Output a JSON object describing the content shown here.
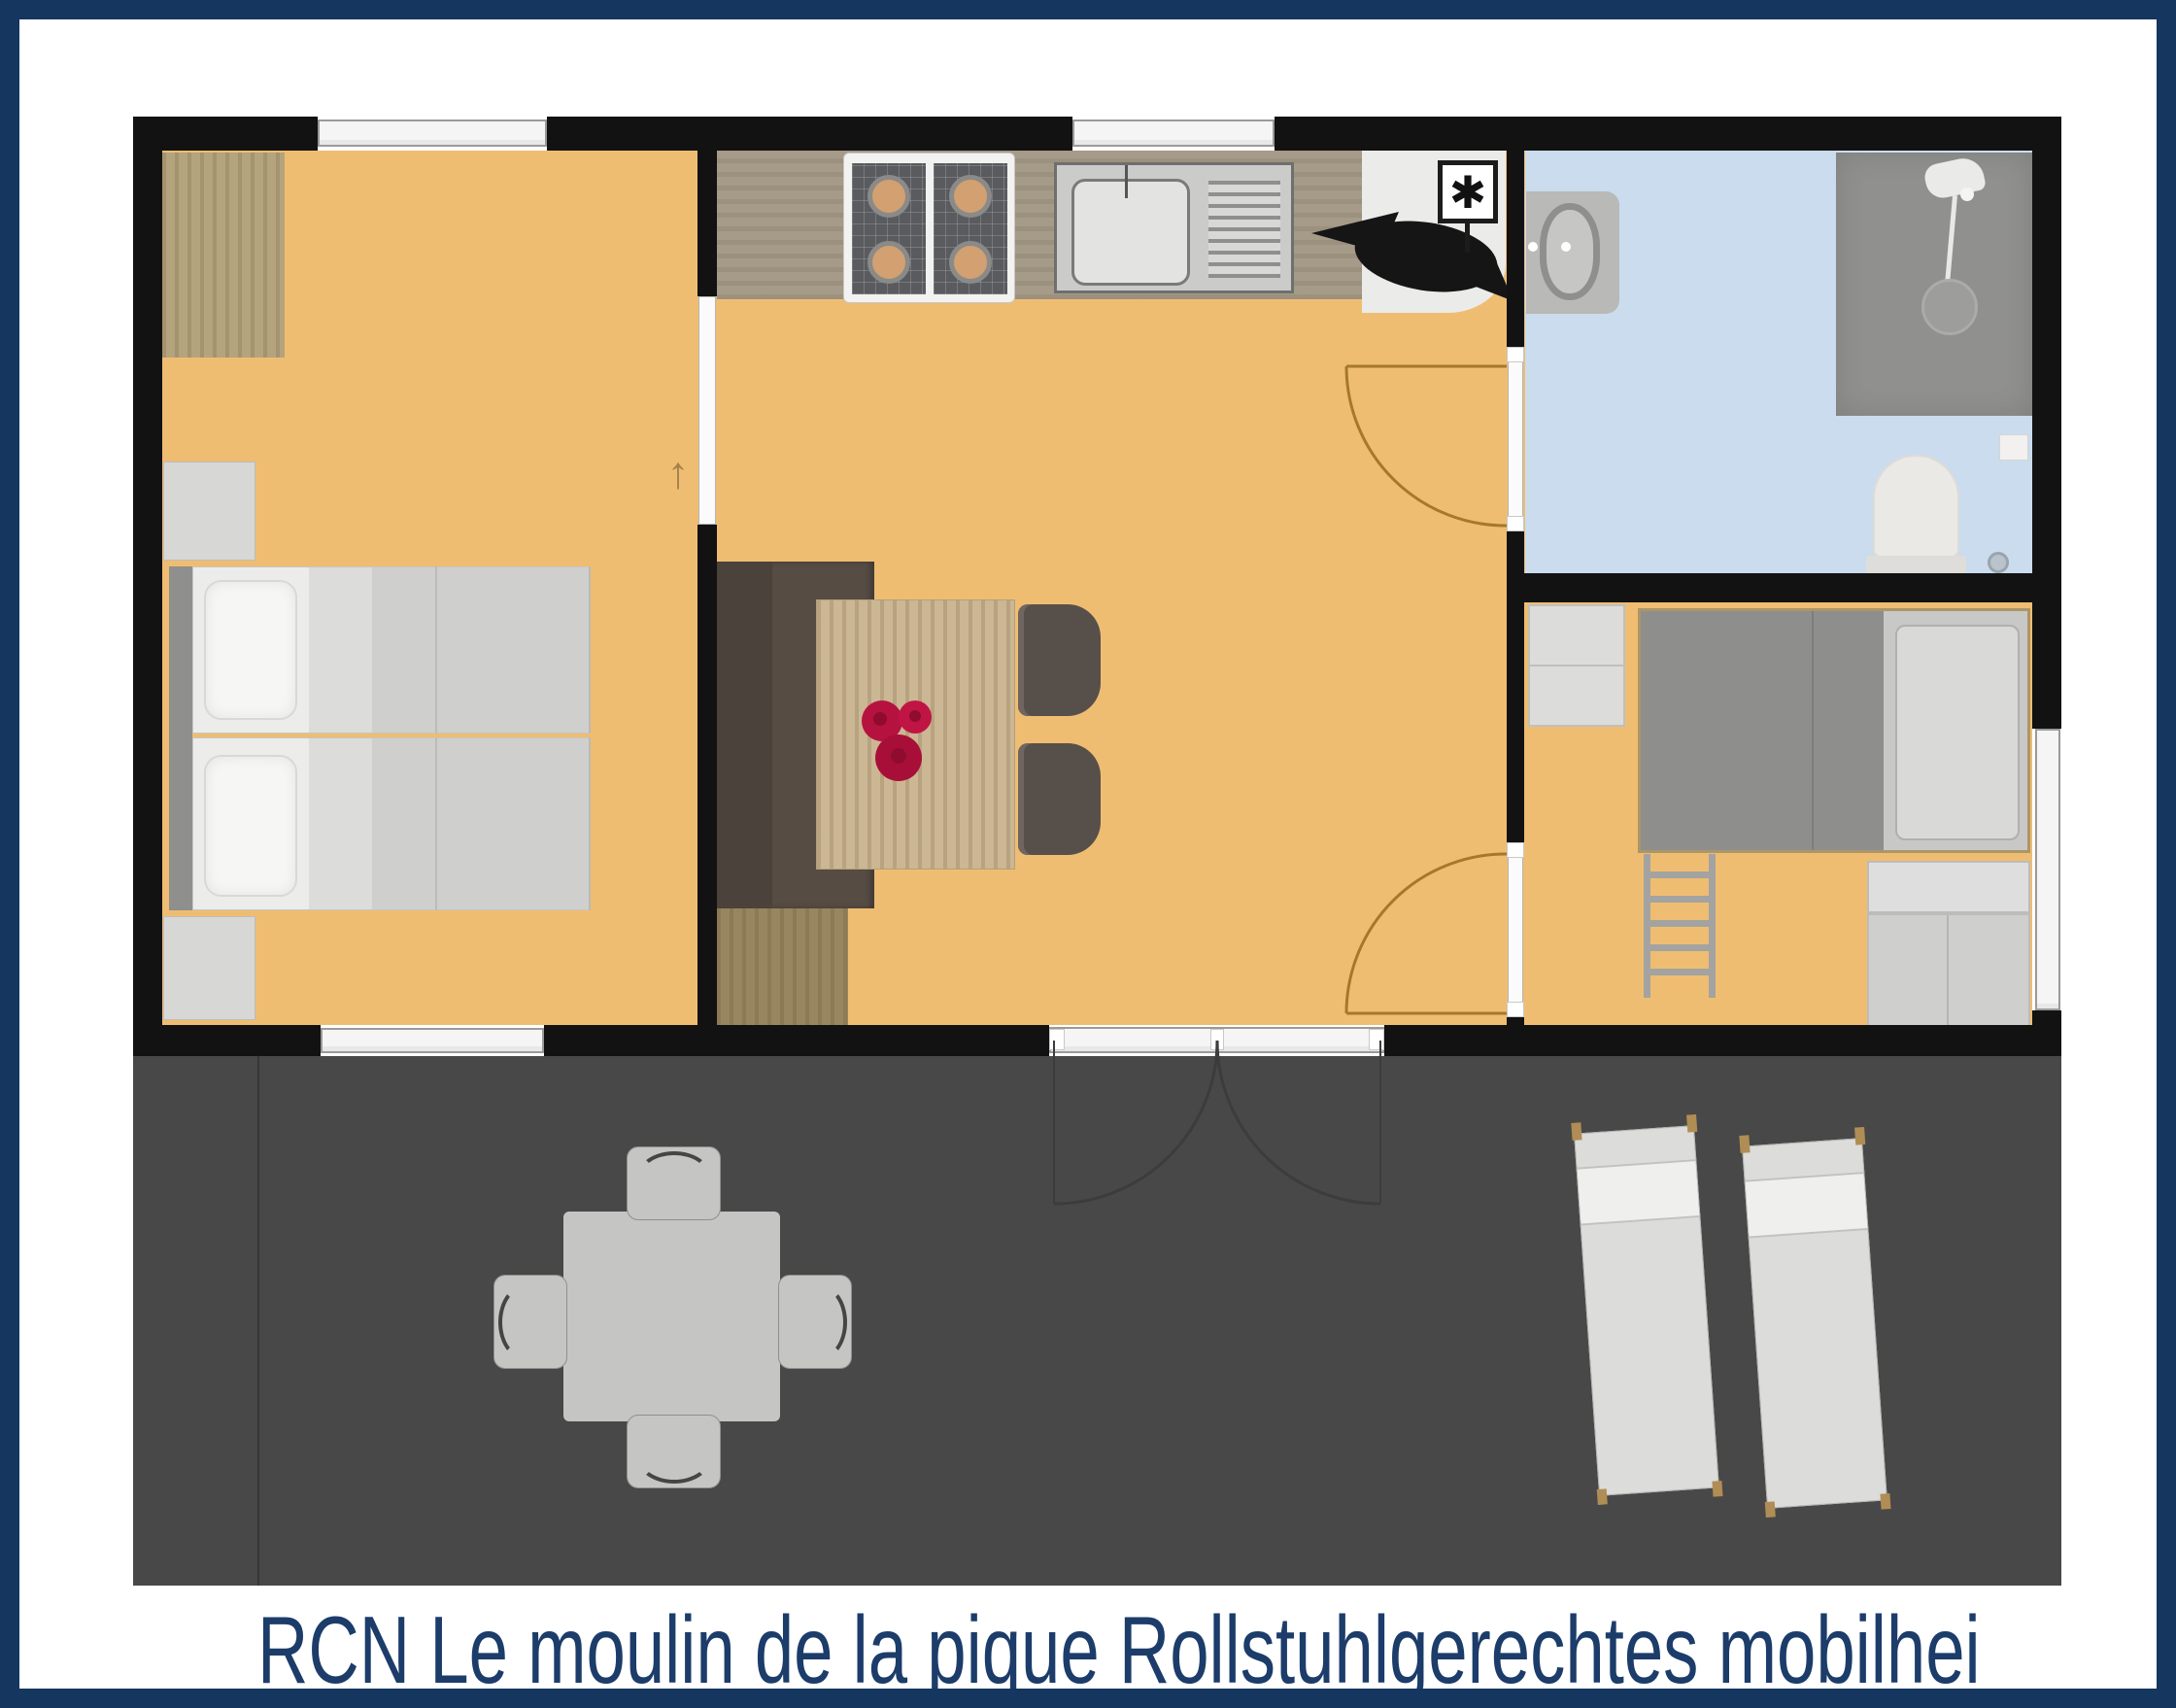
{
  "title": {
    "text": "RCN Le moulin de la pique Rollstuhlgerechtes mobilhei"
  },
  "symbols": {
    "boiler": "✱",
    "door_swing_arrow": "↑"
  },
  "colors": {
    "frame_navy": "#14365f",
    "title_navy": "#1c3c6a",
    "wall_black": "#121212",
    "floor_orange": "#efbd72",
    "floor_blue": "#cadced",
    "terrace_gray": "#484848",
    "counter_taupe": "#a69a89",
    "utility_gray": "#ebebe9",
    "window_white": "#f5f5f5",
    "window_frame": "#9a9a9a",
    "door_arc_brown": "#a5782e",
    "terrace_arc_gray": "#3c3c3c",
    "wood_wardrobe": "#b4a47e",
    "wood_table": "#ccb795",
    "wood_cabinet": "#97865f",
    "bench_brown": "#4b423b",
    "bench_seat_brown": "#564c44",
    "furniture_light_gray": "#d7d7d5",
    "mattress_gray": "#cfcfcd",
    "bed_dark_gray": "#8e8e8c",
    "shower_gray": "#90908e",
    "flower_red": "#b5123f",
    "lounger_gray": "#dcdcda",
    "patio_gray": "#c5c5c3"
  },
  "plan": {
    "rooms": [
      {
        "name": "bedroom-double"
      },
      {
        "name": "living-room-kitchen"
      },
      {
        "name": "bathroom"
      },
      {
        "name": "bedroom-bunk"
      },
      {
        "name": "terrace"
      }
    ],
    "objects": [
      "wardrobe",
      "double-bed",
      "nightstands",
      "kitchen-counter",
      "stove",
      "sink",
      "boiler",
      "decorative-bird",
      "bench",
      "dining-table",
      "flower-bouquet",
      "dining-chairs",
      "washbasin",
      "shower",
      "toilet",
      "bunk-bed",
      "ladder",
      "closet",
      "patio-table",
      "patio-chairs",
      "sun-loungers",
      "french-doors",
      "windows",
      "door-swing-arcs"
    ]
  }
}
